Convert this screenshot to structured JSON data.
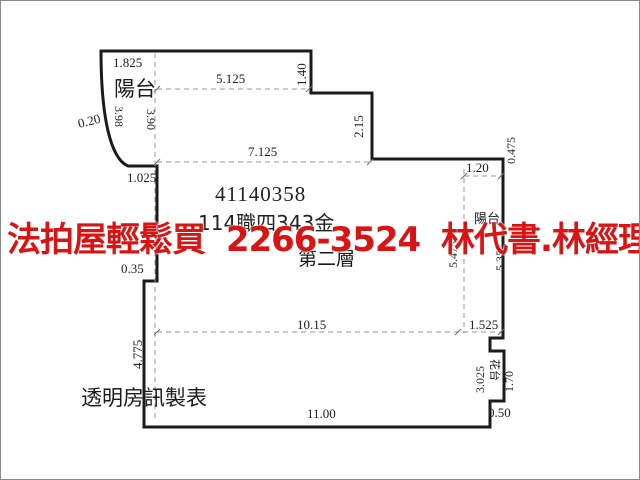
{
  "window": {
    "background": "#ffffff",
    "border_color": "#8a8a8a"
  },
  "watermark": {
    "text": "法拍屋輕鬆買 2266-3524 林代書.林經理",
    "color": "#d81414"
  },
  "plan": {
    "case_id": "41140358",
    "case_number": "114職四343金",
    "floor_label": "第二層",
    "maker_label": "透明房訊製表",
    "labels": {
      "left_balcony": "陽台",
      "right_balcony": "陽台",
      "planter": "花台"
    },
    "dimensions": {
      "top_left_width": "1.825",
      "top_width": "5.125",
      "top_step_height": "1.40",
      "mid_width": "7.125",
      "right_step_height": "2.15",
      "balcony_offset": "0.20",
      "balcony_arc_length": "3.98",
      "balcony_height": "3.90",
      "balcony_bottom_width": "1.025",
      "right_top_step": "0.475",
      "right_balcony_width": "1.20",
      "right_balcony_length_inner": "5.475",
      "right_balcony_length_outer": "5.35",
      "lower_width": "10.15",
      "lower_right_width": "1.525",
      "left_lower_height": "4.775",
      "left_step_width": "0.35",
      "planter_section_height": "3.025",
      "planter_length": "1.70",
      "planter_depth": "0.50",
      "bottom_width": "11.00"
    }
  }
}
